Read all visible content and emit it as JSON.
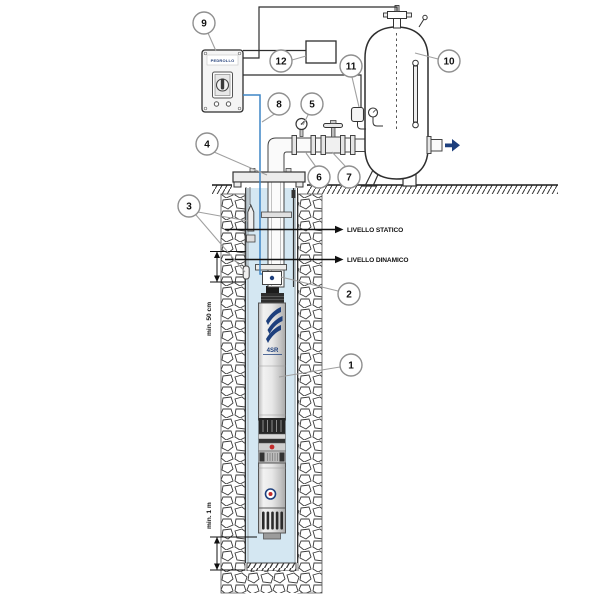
{
  "diagram_title": "Submersible pump well installation diagram",
  "labels": {
    "static_level": "LIVELLO STATICO",
    "dynamic_level": "LIVELLO DINAMICO",
    "min_depth_below_dynamic": "min. 50 cm",
    "min_height_above_bottom": "min. 1 m"
  },
  "pump": {
    "model": "4SR"
  },
  "panel": {
    "logo": "PEDROLLO"
  },
  "callouts": [
    "1",
    "2",
    "3",
    "4",
    "5",
    "6",
    "7",
    "8",
    "9",
    "10",
    "11",
    "12"
  ],
  "colors": {
    "line": "#2e2e2e",
    "leader_gray": "#a0a0a0",
    "water_blue": "#d4e7f2",
    "cable_blue": "#3e86c6",
    "accent_navy": "#1d3f7d",
    "marker_red": "#c32b2b"
  }
}
